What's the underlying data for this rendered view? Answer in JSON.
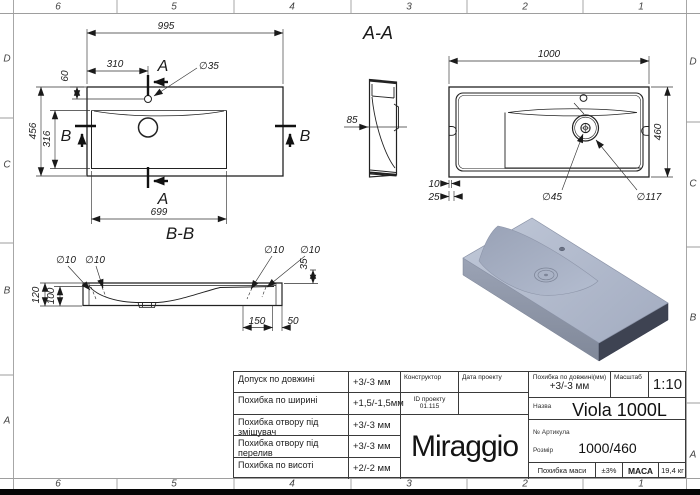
{
  "frame": {
    "columns": [
      "6",
      "5",
      "4",
      "3",
      "2",
      "1"
    ],
    "rows": [
      "D",
      "C",
      "B",
      "A"
    ]
  },
  "plan_view": {
    "section_label_a_top": "A",
    "section_label_a_bottom": "A",
    "section_label_b_left": "B",
    "section_label_b_right": "B",
    "dim_width": "995",
    "dim_faucet_offset": "310",
    "dim_faucet_depth": "60",
    "dim_depth": "456",
    "dim_basin_depth": "316",
    "dim_basin_width": "699",
    "dim_faucet_hole": "∅35"
  },
  "section_aa": {
    "title": "A-A",
    "dim_thickness": "85"
  },
  "section_bb": {
    "title": "B-B",
    "dim_hole1": "∅10",
    "dim_hole2": "∅10",
    "dim_hole3": "∅10",
    "dim_hole4": "∅10",
    "dim_height": "120",
    "dim_inner_height": "100",
    "dim_edge_height": "35",
    "dim_hole_offset": "150",
    "dim_edge_offset": "50"
  },
  "bottom_view": {
    "dim_width": "1000",
    "dim_depth": "460",
    "dim_drain": "∅45",
    "dim_drain_outer": "∅117",
    "dim_off1": "10",
    "dim_off2": "25"
  },
  "title_block": {
    "tolerances": [
      {
        "label": "Допуск по довжині",
        "value": "+3/-3 мм"
      },
      {
        "label": "Похибка по ширині",
        "value": "+1,5/-1,5мм"
      },
      {
        "label": "Похибка отвору під змішувач",
        "value": "+3/-3 мм"
      },
      {
        "label": "Похибка отвору під перелив",
        "value": "+3/-3 мм"
      },
      {
        "label": "Похибка по висоті",
        "value": "+2/-2 мм"
      }
    ],
    "constructor_label": "Конструктор",
    "project_date_label": "Дата проекту",
    "project_id_label": "ID проекту",
    "project_id_value": "01.115",
    "logo": "Miraggio",
    "length_tolerance_label": "Похибка по довжині(мм)",
    "length_tolerance_value": "+3/-3 мм",
    "scale_label": "Масштаб",
    "scale_value": "1:10",
    "name_label": "Назва",
    "name_value": "Viola 1000L",
    "article_label": "№ Артикула",
    "size_label": "Розмір",
    "size_value": "1000/460",
    "mass_tolerance_label": "Похибка маси",
    "mass_tolerance_value": "±3%",
    "mass_label": "МАСА",
    "mass_value": "19,4 кг"
  },
  "colors": {
    "line": "#222222",
    "frame": "#9a9a9a",
    "model_top": "#b7c0d3",
    "model_front": "#99a1b3",
    "model_side": "#3e4352"
  }
}
